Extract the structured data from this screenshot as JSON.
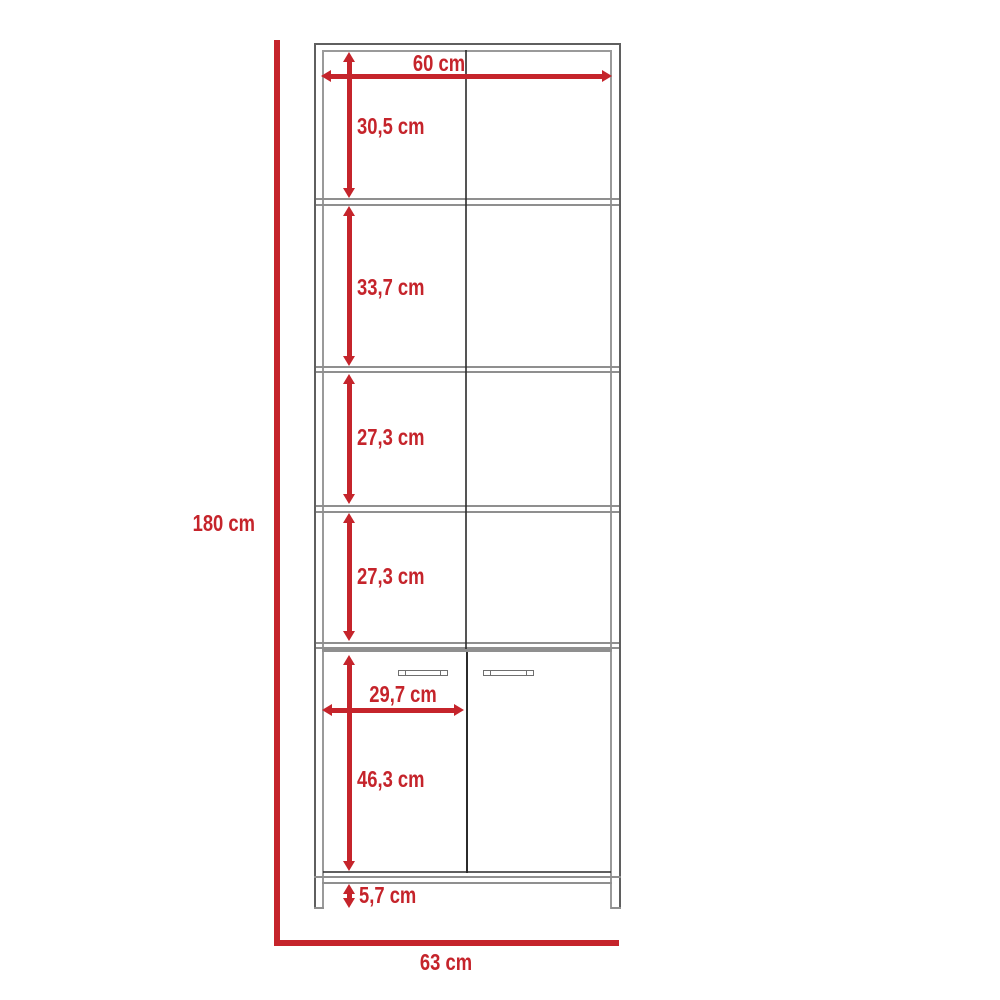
{
  "diagram": {
    "type": "furniture-dimension-diagram",
    "colors": {
      "accent": "#c5242b",
      "outline": "#5f5f5f",
      "outline_light": "#9a9a9a",
      "outline_dark": "#2b2b2b",
      "shelf": "#8f8f8f"
    }
  },
  "dimensions": {
    "total_height": "180 cm",
    "top_width": "60 cm",
    "section_1_height": "30,5 cm",
    "section_2_height": "33,7 cm",
    "section_3_height": "27,3 cm",
    "section_4_height": "27,3 cm",
    "door_width": "29,7 cm",
    "door_section_height": "46,3 cm",
    "base_clearance": "5,7 cm",
    "total_width": "63 cm"
  }
}
